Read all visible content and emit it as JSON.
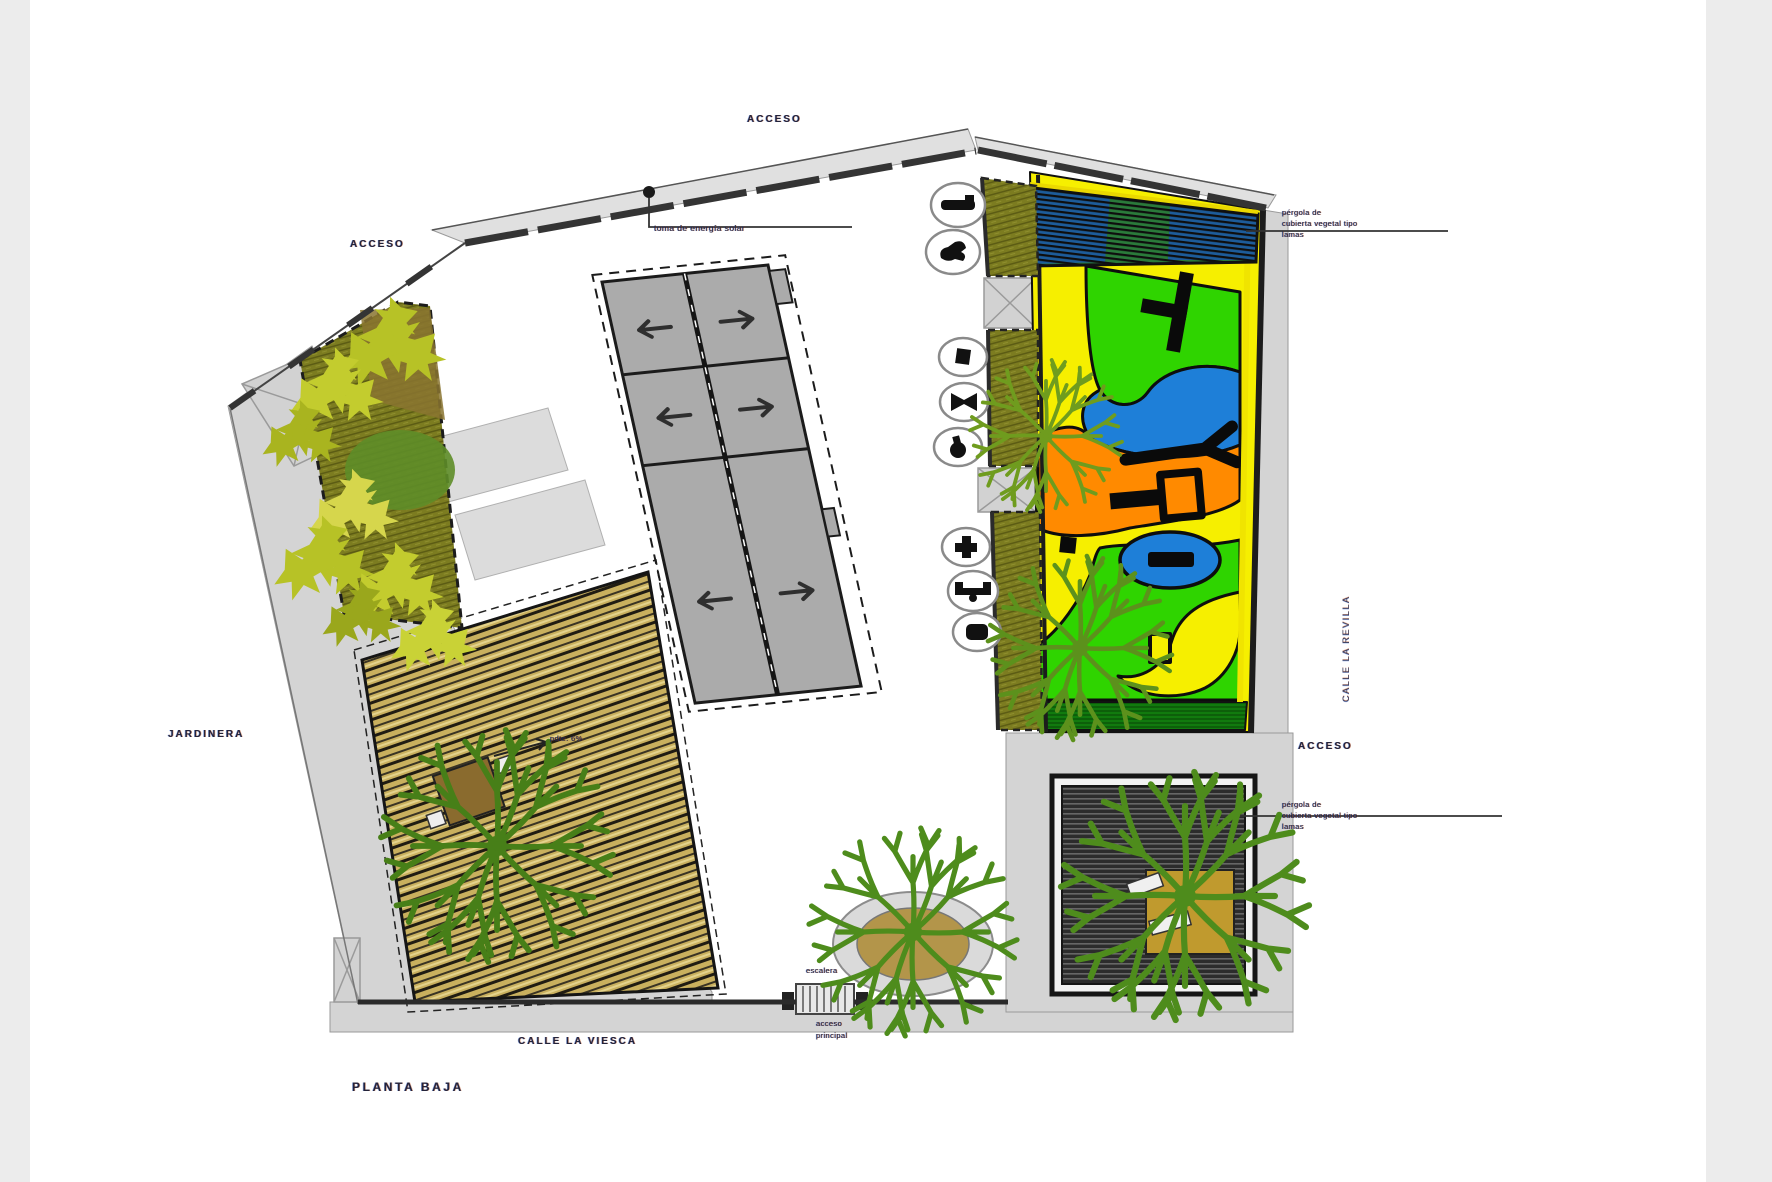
{
  "plan": {
    "title": "planta baja",
    "streets": {
      "bottom": "calle la viesca",
      "right_vertical": "calle la revilla"
    },
    "labels": {
      "access_top": "acceso",
      "access_left": "acceso",
      "access_right": "acceso",
      "main_access_l1": "acceso",
      "main_access_l2": "principal",
      "stair_note": "escalera",
      "planter_note": "jardinera",
      "solar_note": "toma de energía solar",
      "slope_note": "pdte. 6%",
      "pergola_l1": "pérgola de",
      "pergola_l2": "cubierta vegetal tipo",
      "pergola_l3": "lamas"
    },
    "legend": {
      "badges": [
        {
          "icon": "bench-icon"
        },
        {
          "icon": "animal-spring-icon"
        },
        {
          "icon": "cube-icon"
        },
        {
          "icon": "seesaw-icon"
        },
        {
          "icon": "spring-toy-icon"
        },
        {
          "icon": "cross-toy-icon"
        },
        {
          "icon": "balance-bar-icon"
        },
        {
          "icon": "play-block-icon"
        }
      ]
    },
    "ramp_arrows": [
      "left",
      "right",
      "left",
      "right",
      "left",
      "right"
    ],
    "colors": {
      "playground_yellow": "#f6ef00",
      "playground_green": "#2fd400",
      "playground_blue": "#1e7fd8",
      "playground_orange": "#ff8a00",
      "dark_green_strip": "#117a0e",
      "deck_wood": "#c9b05e",
      "planter_olive": "#7c7c20",
      "foliage_yellow_green": "#c3cc2e",
      "tree_green": "#4e8c1c",
      "concrete_gray": "#d4d4d4",
      "ramp_gray": "#ababab",
      "wall_dark": "#2b2b2b",
      "pergola_border_yellow": "#ead800"
    }
  }
}
